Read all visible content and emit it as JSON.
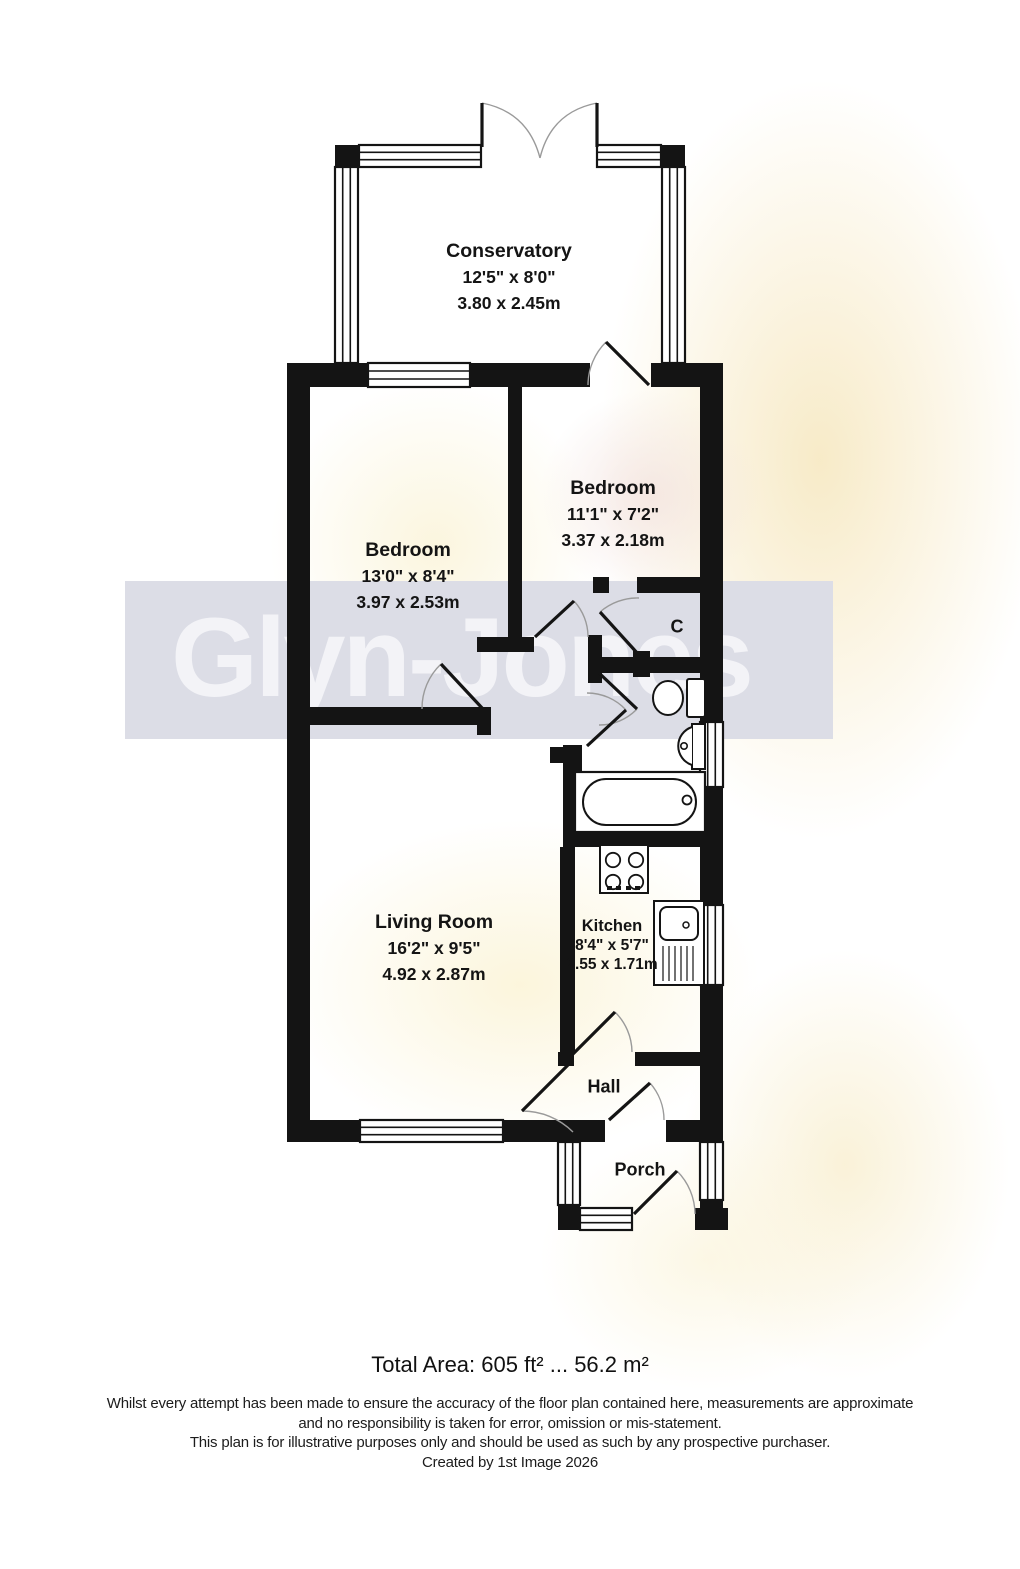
{
  "watermark": {
    "brand": "Glyn-Jones",
    "band_color": "#dcdde6"
  },
  "rooms": {
    "conservatory": {
      "name": "Conservatory",
      "imperial": "12'5\" x 8'0\"",
      "metric": "3.80 x 2.45m"
    },
    "bedroom1": {
      "name": "Bedroom",
      "imperial": "13'0\" x 8'4\"",
      "metric": "3.97 x 2.53m"
    },
    "bedroom2": {
      "name": "Bedroom",
      "imperial": "11'1\" x 7'2\"",
      "metric": "3.37 x 2.18m"
    },
    "living": {
      "name": "Living Room",
      "imperial": "16'2\" x 9'5\"",
      "metric": "4.92 x 2.87m"
    },
    "kitchen": {
      "name": "Kitchen",
      "imperial": "8'4\" x 5'7\"",
      "metric": "2.55 x 1.71m"
    },
    "hall": {
      "name": "Hall"
    },
    "porch": {
      "name": "Porch"
    },
    "cupboard": {
      "name": "C"
    }
  },
  "footer": {
    "total_area": "Total Area: 605 ft² ... 56.2 m²",
    "disclaimer_line1": "Whilst every attempt has been made to ensure the accuracy of the floor plan contained here, measurements are approximate",
    "disclaimer_line2": "and no responsibility is taken for error, omission or mis-statement.",
    "disclaimer_line3": "This plan is for illustrative purposes only and should be used as such by any prospective purchaser.",
    "credit": "Created by 1st Image 2026"
  }
}
